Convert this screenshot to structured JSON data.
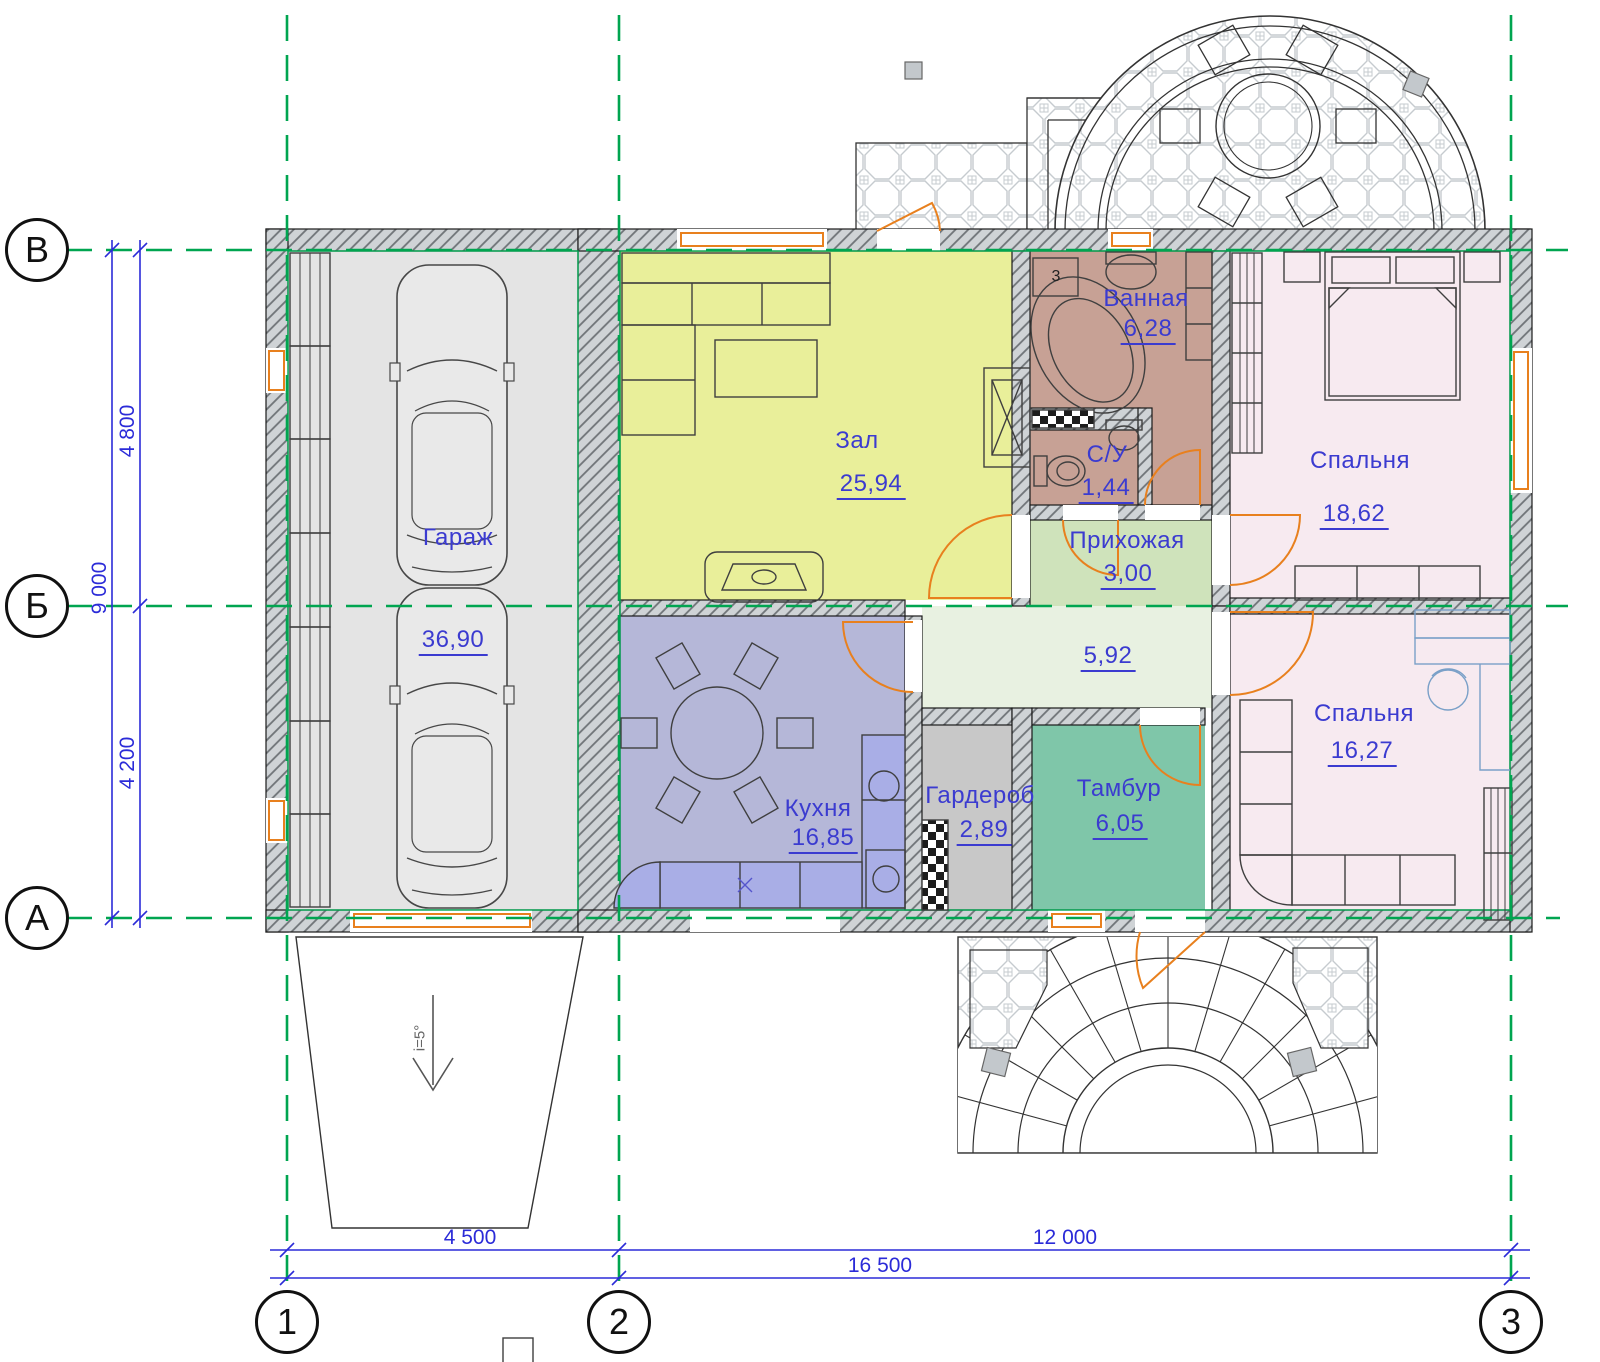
{
  "axes": {
    "rows": [
      "В",
      "Б",
      "А"
    ],
    "cols": [
      "1",
      "2",
      "3"
    ]
  },
  "dims": {
    "total_height": "9 000",
    "span_top": "4 800",
    "span_bottom": "4 200",
    "span_left": "4 500",
    "span_right": "12 000",
    "total_width": "16 500",
    "slope": "i=5°"
  },
  "rooms": {
    "garage": {
      "name": "Гараж",
      "area": "36,90"
    },
    "hall": {
      "name": "Зал",
      "area": "25,94"
    },
    "bathroom": {
      "name": "Ванная",
      "area": "6,28",
      "marker": "3"
    },
    "wc": {
      "name": "С/У",
      "area": "1,44"
    },
    "entry": {
      "name": "Прихожая",
      "area": "3,00"
    },
    "corridor": {
      "name": "",
      "area": "5,92"
    },
    "bedroom1": {
      "name": "Спальня",
      "area": "18,62"
    },
    "kitchen": {
      "name": "Кухня",
      "area": "16,85"
    },
    "wardrobe": {
      "name": "Гардероб",
      "area": "2,89"
    },
    "vestibule": {
      "name": "Тамбур",
      "area": "6,05"
    },
    "bedroom2": {
      "name": "Спальня",
      "area": "16,27"
    }
  },
  "colors": {
    "axis_green": "#00a550",
    "dimension_blue": "#2b2bd8",
    "label_blue": "#3b3bd0",
    "opening_orange": "#e8801e",
    "garage_fill": "#e4e4e4",
    "hall_fill": "#e9ef9a",
    "bathroom_fill": "#c7a195",
    "entry_fill": "#cfe3bb",
    "corridor_fill": "#e8f1e1",
    "kitchen_fill": "#b5b7d8",
    "counter_fill": "#a9aee6",
    "wardrobe_fill": "#c8c8c8",
    "vestibule_fill": "#7fc6a9",
    "bedroom_fill": "#f7eaf0",
    "wall_hatch": "#cfd3d6"
  }
}
